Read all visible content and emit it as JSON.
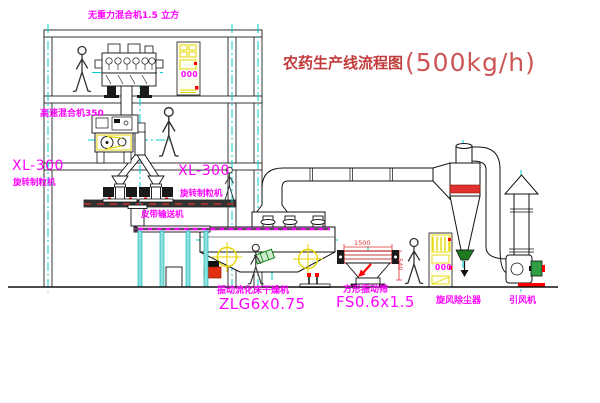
{
  "title": {
    "prefix": "农药生产线流程图",
    "capacity": "(500kg/h)"
  },
  "labels": {
    "gravity_free_mixer": "无重力混合机1.5 立方",
    "high_speed_mixer": "高速混合机350",
    "granulator_left_model": "XL-300",
    "granulator_left_name": "旋转制粒机",
    "granulator_right_model": "XL-300",
    "granulator_right_name": "旋转制粒机",
    "belt_conveyor": "皮带输送机",
    "dryer_name": "振动流化床干燥机",
    "dryer_model": "ZLG6x0.75",
    "sieve_name": "方形振动筛",
    "sieve_model": "FS0.6x1.5",
    "cyclone": "旋风除尘器",
    "fan": "引风机"
  },
  "dimensions": {
    "sieve_length": "1500",
    "sieve_height": "540"
  },
  "panels": {
    "panel1": "000",
    "panel2": "000"
  },
  "colors": {
    "magenta": "#ff00ff",
    "cyan": "#00cccc",
    "yellow": "#e6d600",
    "red": "#ff0000",
    "title_red": "#c23b3b",
    "dim_red": "#e03030",
    "green": "#0a7a0a"
  }
}
